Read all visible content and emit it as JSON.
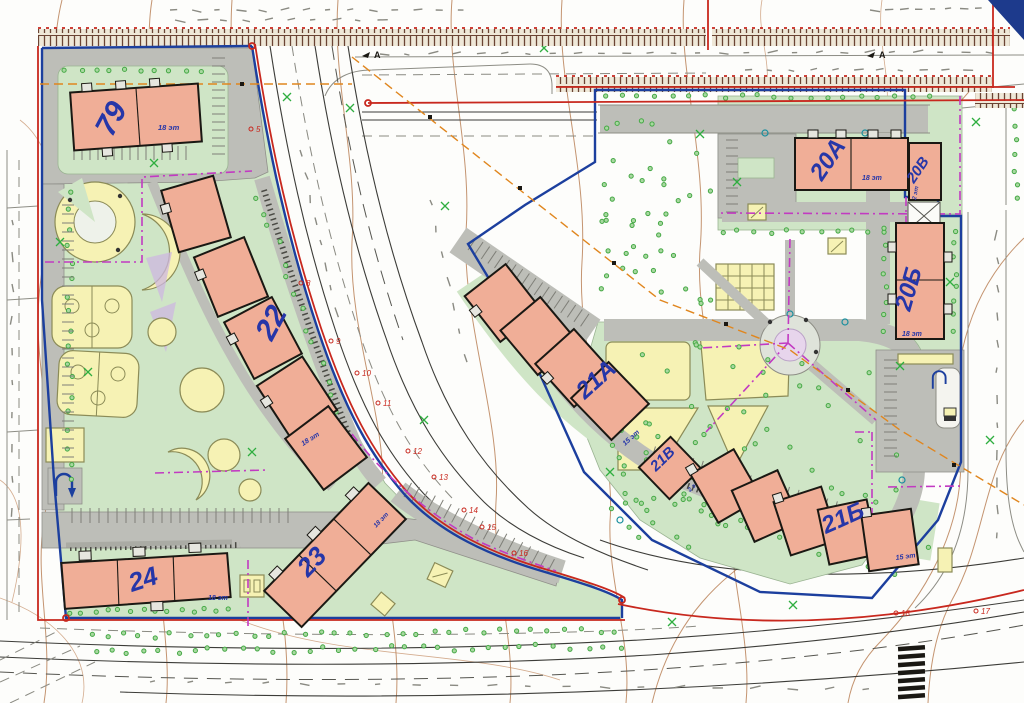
{
  "map": {
    "kind": "residential-site-plan",
    "buildings": [
      {
        "key": "b79",
        "label": "79",
        "floors": "18 эт"
      },
      {
        "key": "b22",
        "label": "22",
        "floors": "18 эт"
      },
      {
        "key": "b23",
        "label": "23",
        "floors": "18 эт"
      },
      {
        "key": "b24",
        "label": "24",
        "floors": "18 эт"
      },
      {
        "key": "b20a",
        "label": "20А",
        "floors": "18 эт"
      },
      {
        "key": "b20b",
        "label": "20Б",
        "floors": "18 эт"
      },
      {
        "key": "b20v",
        "label": "20В",
        "floors": "2 эт"
      },
      {
        "key": "b21a",
        "label": "21А",
        "floors": "15 эт"
      },
      {
        "key": "b21b",
        "label": "21Б",
        "floors": "15 эт"
      },
      {
        "key": "b21v",
        "label": "21В",
        "floors": "2 эт"
      }
    ],
    "boundary_vertex_labels": [
      {
        "n": "5",
        "x": 256,
        "y": 132
      },
      {
        "n": "8",
        "x": 306,
        "y": 286
      },
      {
        "n": "9",
        "x": 336,
        "y": 344
      },
      {
        "n": "10",
        "x": 362,
        "y": 376
      },
      {
        "n": "11",
        "x": 383,
        "y": 406
      },
      {
        "n": "12",
        "x": 413,
        "y": 454
      },
      {
        "n": "13",
        "x": 439,
        "y": 480
      },
      {
        "n": "14",
        "x": 469,
        "y": 513
      },
      {
        "n": "15",
        "x": 487,
        "y": 530
      },
      {
        "n": "16",
        "x": 519,
        "y": 556
      },
      {
        "n": "17",
        "x": 981,
        "y": 614
      },
      {
        "n": "18",
        "x": 901,
        "y": 616
      }
    ],
    "road_markers": [
      {
        "label": "А",
        "x": 374,
        "y": 58
      },
      {
        "label": "А",
        "x": 879,
        "y": 58
      }
    ],
    "colors": {
      "building_fill": "#f0ae97",
      "building_outline": "#1a1813",
      "site_green": "#cfe5c6",
      "play_yellow": "#f6f2b4",
      "road_gray": "#bdbeb8",
      "boundary_red": "#c8281e",
      "boundary_blue": "#1c3f9e",
      "utility_magenta": "#c23ac2",
      "label_blue": "#2636a8",
      "contour_brown": "#b5794e",
      "tree_green": "#44a844",
      "utility_orange": "#e0861e"
    }
  }
}
